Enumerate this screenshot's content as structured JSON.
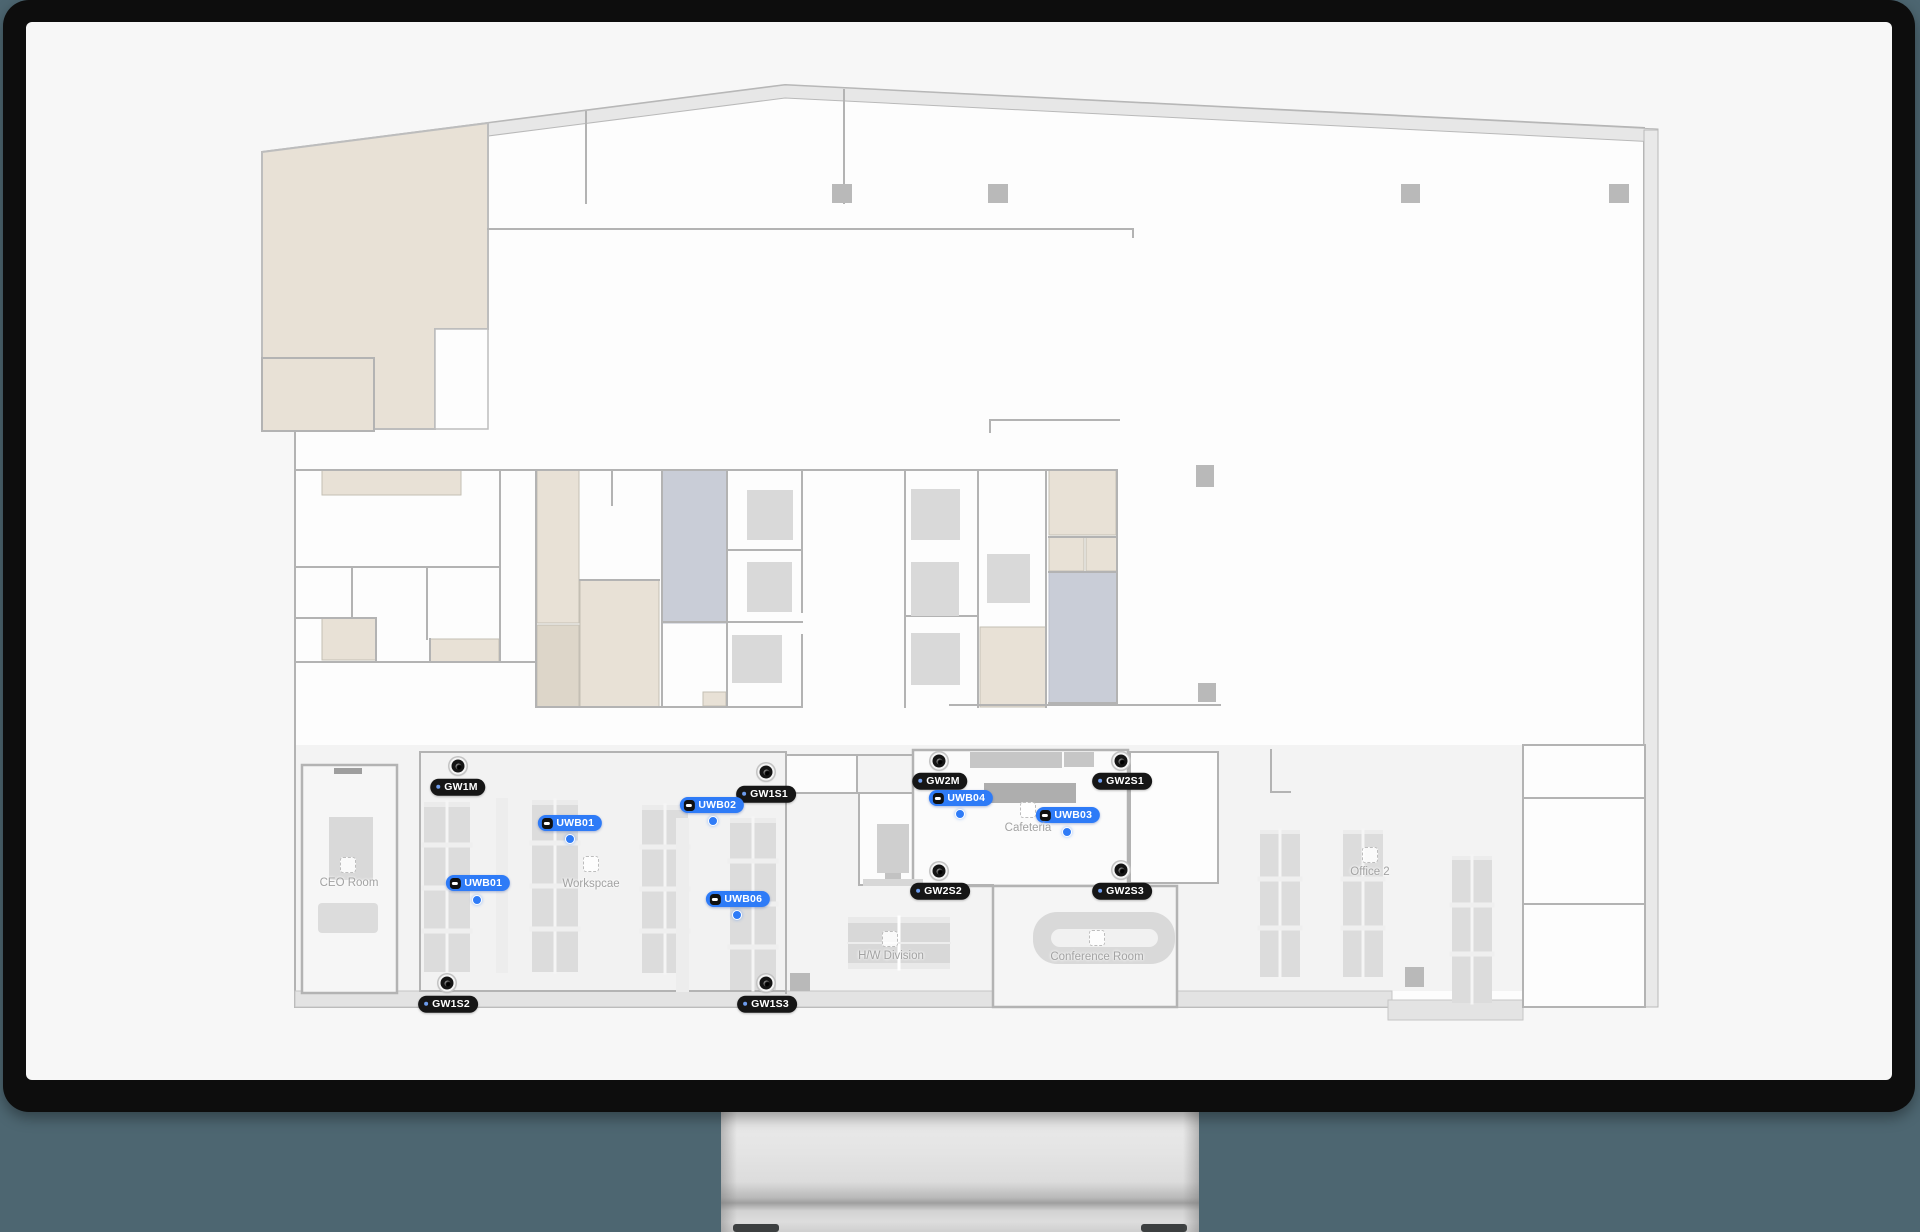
{
  "scene": {
    "background_color": "#4d6671",
    "monitor_bezel_color": "#0d0d0d",
    "screen_color": "#f7f7f7"
  },
  "floorplan": {
    "colors": {
      "wall": "#b3b3b3",
      "beige_room": "#e8e1d6",
      "bluegray_room": "#c9cdd7",
      "furniture": "#d9d9d9",
      "tag_accent": "#2e7bf7",
      "gateway_badge": "#161616"
    },
    "rooms": [
      {
        "id": "ceo-room",
        "label": "CEO Room",
        "x": 349,
        "y": 883,
        "icon_x": 348,
        "icon_y": 865
      },
      {
        "id": "workspace",
        "label": "Workspcae",
        "x": 591,
        "y": 884,
        "icon_x": 591,
        "icon_y": 864
      },
      {
        "id": "cafeteria",
        "label": "Cafeteria",
        "x": 1028,
        "y": 828,
        "icon_x": 1028,
        "icon_y": 810
      },
      {
        "id": "hw-division",
        "label": "H/W Division",
        "x": 891,
        "y": 956,
        "icon_x": 890,
        "icon_y": 939
      },
      {
        "id": "conference-room",
        "label": "Conference Room",
        "x": 1097,
        "y": 957,
        "icon_x": 1097,
        "icon_y": 938
      },
      {
        "id": "office-2",
        "label": "Office 2",
        "x": 1370,
        "y": 872,
        "icon_x": 1370,
        "icon_y": 855
      }
    ],
    "gateways": [
      {
        "id": "gw1m",
        "label": "GW1M",
        "badge_x": 458,
        "badge_y": 787,
        "anchor_x": 458,
        "anchor_y": 766
      },
      {
        "id": "gw1s1",
        "label": "GW1S1",
        "badge_x": 766,
        "badge_y": 794,
        "anchor_x": 766,
        "anchor_y": 772
      },
      {
        "id": "gw1s2",
        "label": "GW1S2",
        "badge_x": 448,
        "badge_y": 1004,
        "anchor_x": 447,
        "anchor_y": 983
      },
      {
        "id": "gw1s3",
        "label": "GW1S3",
        "badge_x": 767,
        "badge_y": 1004,
        "anchor_x": 766,
        "anchor_y": 983
      },
      {
        "id": "gw2m",
        "label": "GW2M",
        "badge_x": 940,
        "badge_y": 781,
        "anchor_x": 939,
        "anchor_y": 761
      },
      {
        "id": "gw2s1",
        "label": "GW2S1",
        "badge_x": 1122,
        "badge_y": 781,
        "anchor_x": 1121,
        "anchor_y": 761
      },
      {
        "id": "gw2s2",
        "label": "GW2S2",
        "badge_x": 940,
        "badge_y": 891,
        "anchor_x": 939,
        "anchor_y": 871
      },
      {
        "id": "gw2s3",
        "label": "GW2S3",
        "badge_x": 1122,
        "badge_y": 891,
        "anchor_x": 1121,
        "anchor_y": 870
      }
    ],
    "tags": [
      {
        "id": "uwb01-a",
        "label": "UWB01",
        "badge_x": 570,
        "badge_y": 823,
        "dot_x": 570,
        "dot_y": 839
      },
      {
        "id": "uwb02",
        "label": "UWB02",
        "badge_x": 712,
        "badge_y": 805,
        "dot_x": 713,
        "dot_y": 821
      },
      {
        "id": "uwb01-b",
        "label": "UWB01",
        "badge_x": 478,
        "badge_y": 883,
        "dot_x": 477,
        "dot_y": 900
      },
      {
        "id": "uwb06",
        "label": "UWB06",
        "badge_x": 738,
        "badge_y": 899,
        "dot_x": 737,
        "dot_y": 915
      },
      {
        "id": "uwb04",
        "label": "UWB04",
        "badge_x": 961,
        "badge_y": 798,
        "dot_x": 960,
        "dot_y": 814
      },
      {
        "id": "uwb03",
        "label": "UWB03",
        "badge_x": 1068,
        "badge_y": 815,
        "dot_x": 1067,
        "dot_y": 832
      }
    ]
  }
}
